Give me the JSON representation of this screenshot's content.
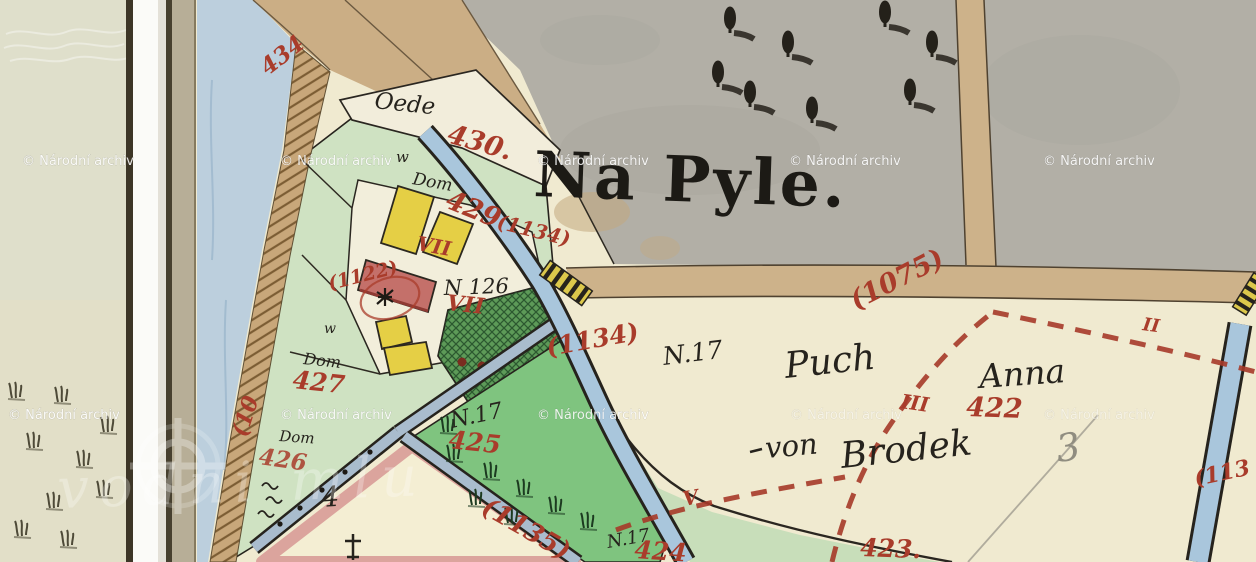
{
  "palette": {
    "red_ink": "#a93c2b",
    "black_ink": "#26231d",
    "paper_cream": "#f0ead0",
    "pasture_gray": "#b2afa6",
    "water_blue": "#a9c6dc",
    "road_tan": "#cdb28a",
    "plot_green": "#cfe2c2",
    "meadow_green": "#7fc47f",
    "orchard_green": "#57904f",
    "building_yellow": "#e5cf45",
    "building_red": "#c4706a",
    "plot_pink": "#dba49d",
    "watermark_white": "#ffffff"
  },
  "watermarks": {
    "archive": "© Národní archiv",
    "portal": "vodni mlu"
  },
  "map": {
    "title": "Na Pyle.",
    "black_labels": {
      "oede": "Oede",
      "w_upper": "w",
      "dom_upper": "Dom",
      "house_number": "N 126",
      "w_lower": "w",
      "dom_mid": "Dom",
      "dom_lower": "Dom",
      "n17_field": "N.17",
      "owner_surname": "Puch",
      "owner_given": "Anna",
      "owner_prefix": "von",
      "owner_place": "Brodek",
      "n17_meadow": "N.17",
      "n17_lower": "N.17",
      "plot_four": "4",
      "pencil_three": "3"
    },
    "red_labels": {
      "n434": "434",
      "n430": "430.",
      "n429": "429",
      "p1134_upper": "(1134)",
      "p1122": "(1122)",
      "n427": "427",
      "p10": "(10",
      "n426": "426",
      "vii_upper": "VII",
      "vii_lower": "VII",
      "p1134_lower": "(1134)",
      "n425": "425",
      "p1135": "(1135)",
      "n424": "424",
      "n423": "423.",
      "n422": "422",
      "p1075": "(1075)",
      "p113": "(113",
      "ii": "II",
      "iii": "III",
      "v": "V"
    }
  }
}
